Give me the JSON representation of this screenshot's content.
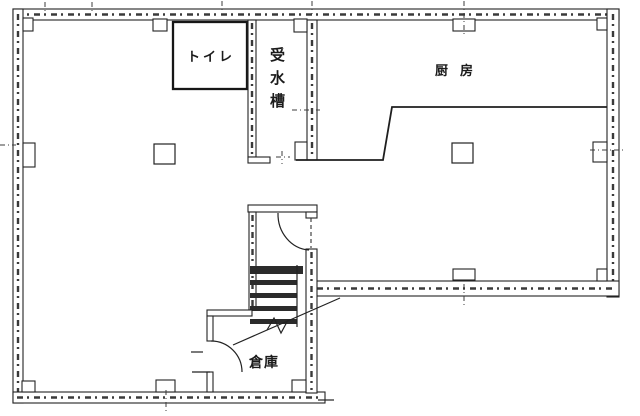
{
  "floorplan": {
    "type": "scanned-architectural-floor-plan",
    "colors": {
      "ink": "#222222",
      "paper": "#ffffff"
    },
    "rooms": [
      {
        "id": "toilet",
        "label": "トイレ"
      },
      {
        "id": "water-tank",
        "label": "受水槽",
        "text_orientation": "vertical"
      },
      {
        "id": "kitchen",
        "label": "厨房"
      },
      {
        "id": "storage",
        "label": "倉庫"
      }
    ],
    "features": [
      "staircase-with-break-line",
      "two-door-swings",
      "structural-columns",
      "grid-center-ticks"
    ]
  }
}
